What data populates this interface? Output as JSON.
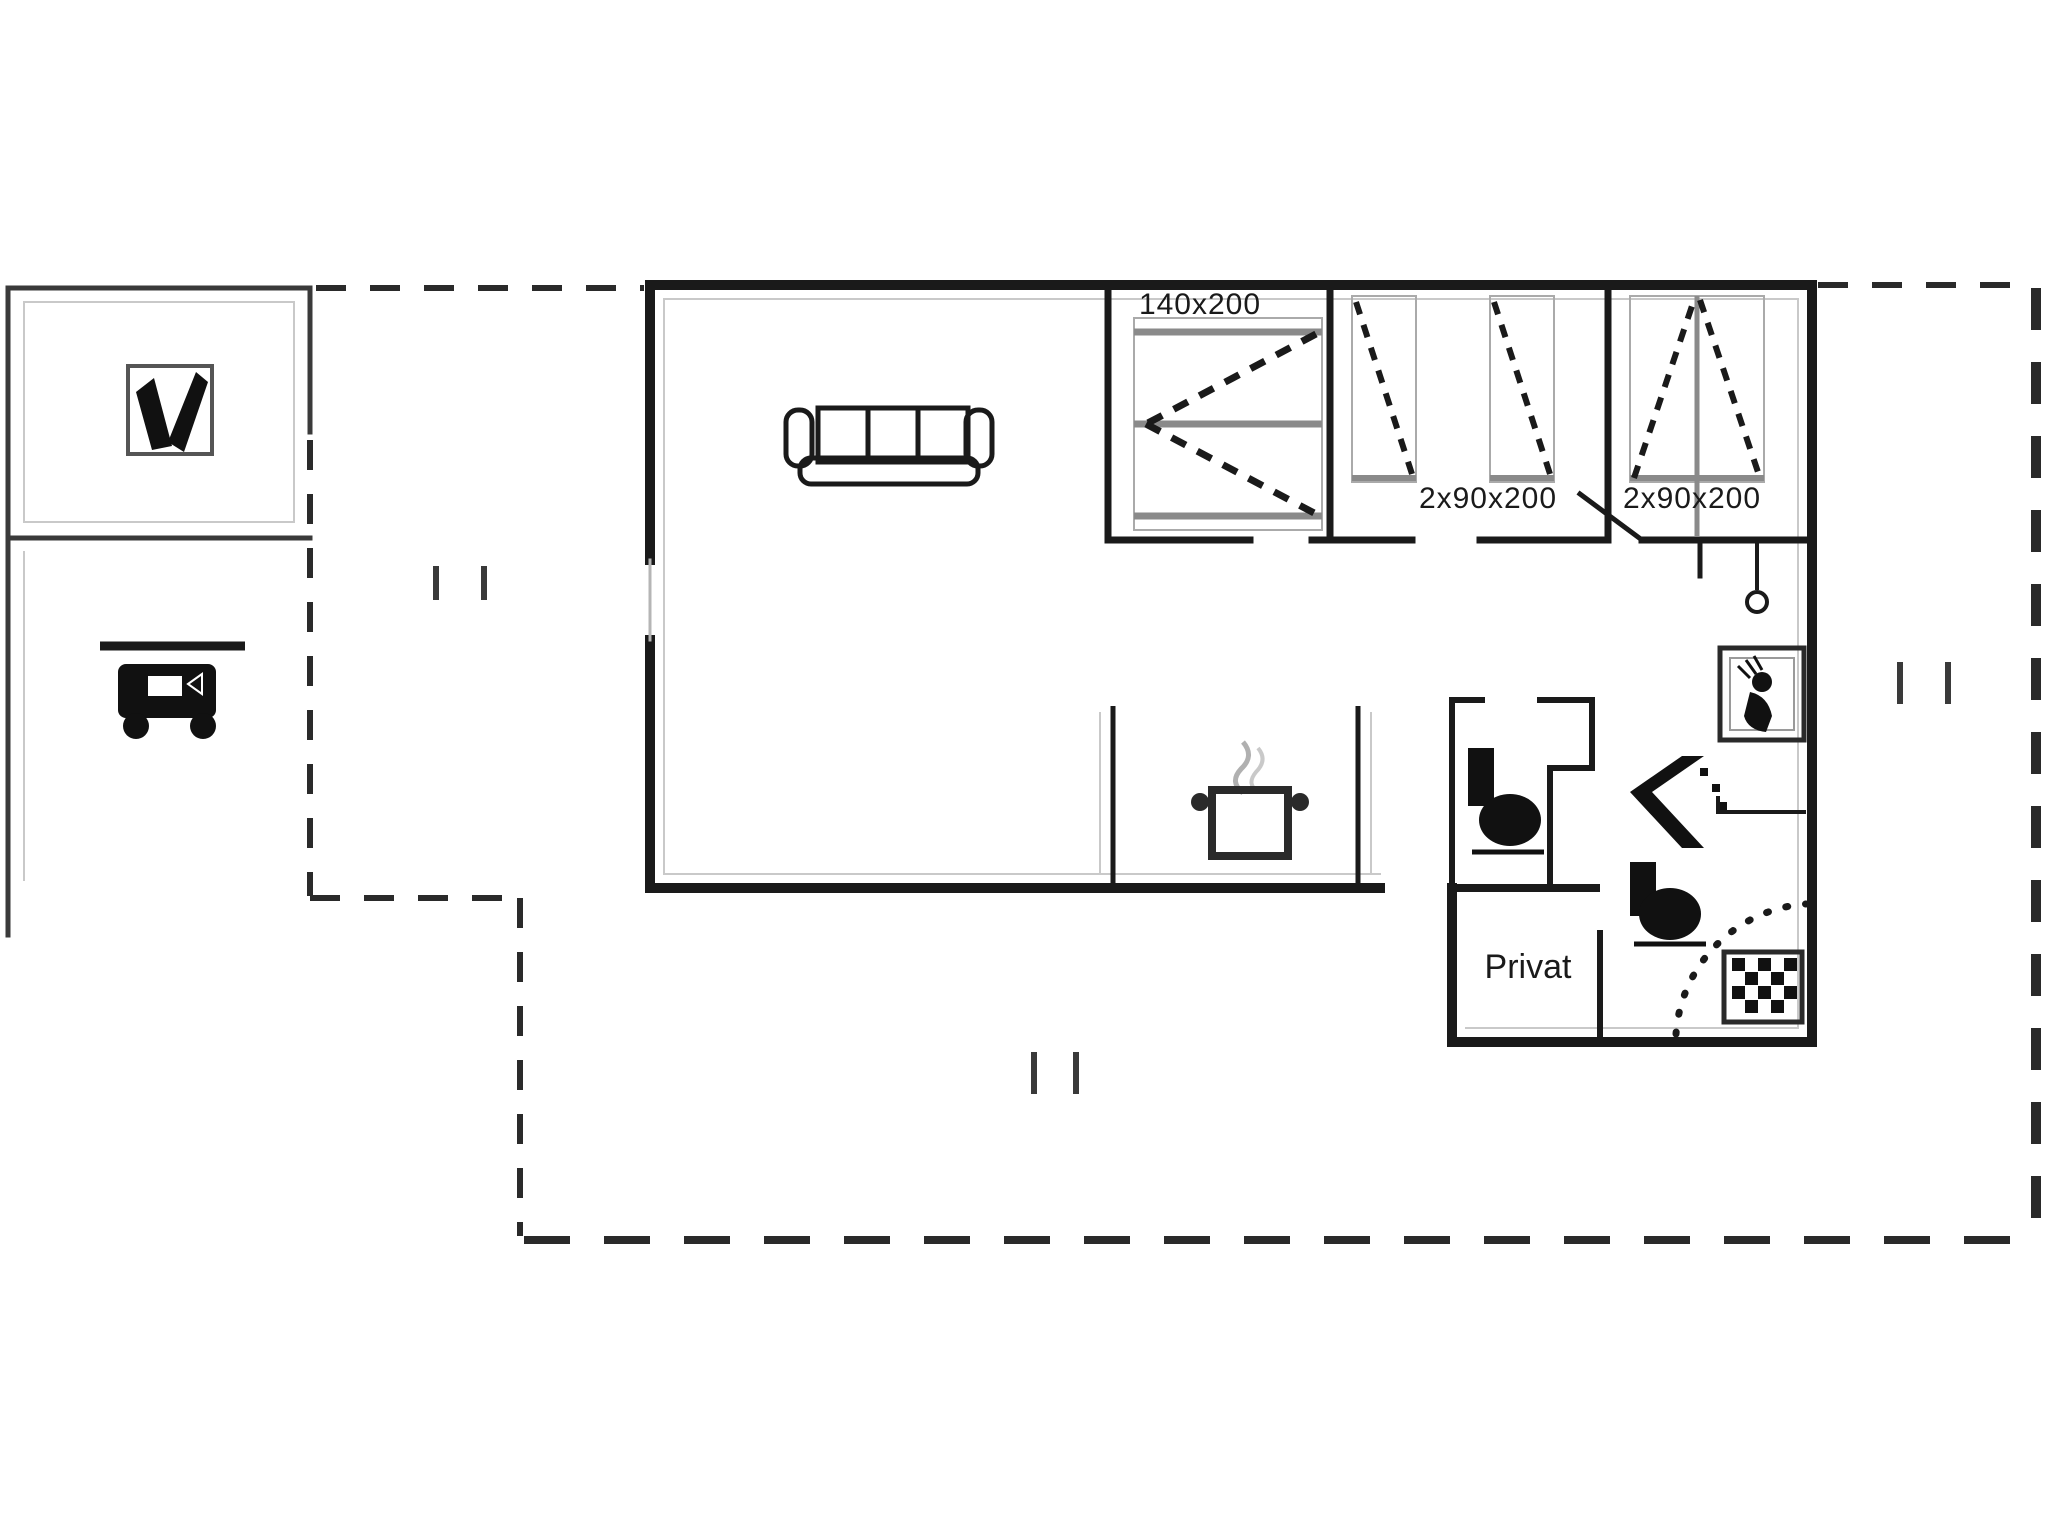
{
  "title": "floor-plan",
  "labels": {
    "bed_double": "140x200",
    "beds_twin": "2x90x200",
    "beds_bunk": "2x90x200",
    "room_private": "Privat"
  },
  "icons": {
    "annex_room": "tv-icon",
    "annex_carport": "grill-icon",
    "living_room": "sofa-icon",
    "kitchen": "cooking-pot-icon",
    "bathroom_shower": "shower-icon",
    "bathroom_sink": "sink-icon",
    "bathroom_toilet": "toilet-icon",
    "wc_toilet": "toilet-icon",
    "bathroom_washer": "washing-machine-icon",
    "beds": "bed-icon"
  },
  "colors": {
    "wall": "#1a1a1a",
    "annex_wall": "#3a3a3a",
    "bed_bar": "#8a8a8a",
    "thin_inner": "#c9c9c9",
    "background": "#ffffff"
  }
}
